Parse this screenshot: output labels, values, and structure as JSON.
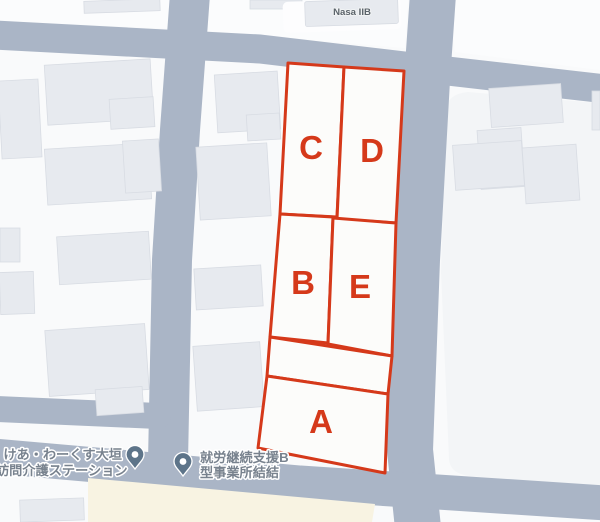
{
  "map": {
    "labels": {
      "nasa": "Nasa IIB",
      "care_line1": "けあ・わーくす大垣",
      "care_line2": "訪問介護ステーション",
      "employment_line1": "就労継続支援B",
      "employment_line2": "型事業所結結"
    },
    "parcels": [
      {
        "id": "a",
        "label": "A"
      },
      {
        "id": "b",
        "label": "B"
      },
      {
        "id": "c",
        "label": "C"
      },
      {
        "id": "d",
        "label": "D"
      },
      {
        "id": "e",
        "label": "E"
      }
    ],
    "colors": {
      "parcel_outline": "#d5391a",
      "road": "#aab5c6",
      "block": "#f9fafb",
      "block_east": "#f3f5f7",
      "building": "#e7eaef",
      "commercial_area": "#f8f3e2",
      "pin": "#5d7489",
      "label_gray": "#78828e",
      "label_dark": "#5c646b"
    }
  }
}
